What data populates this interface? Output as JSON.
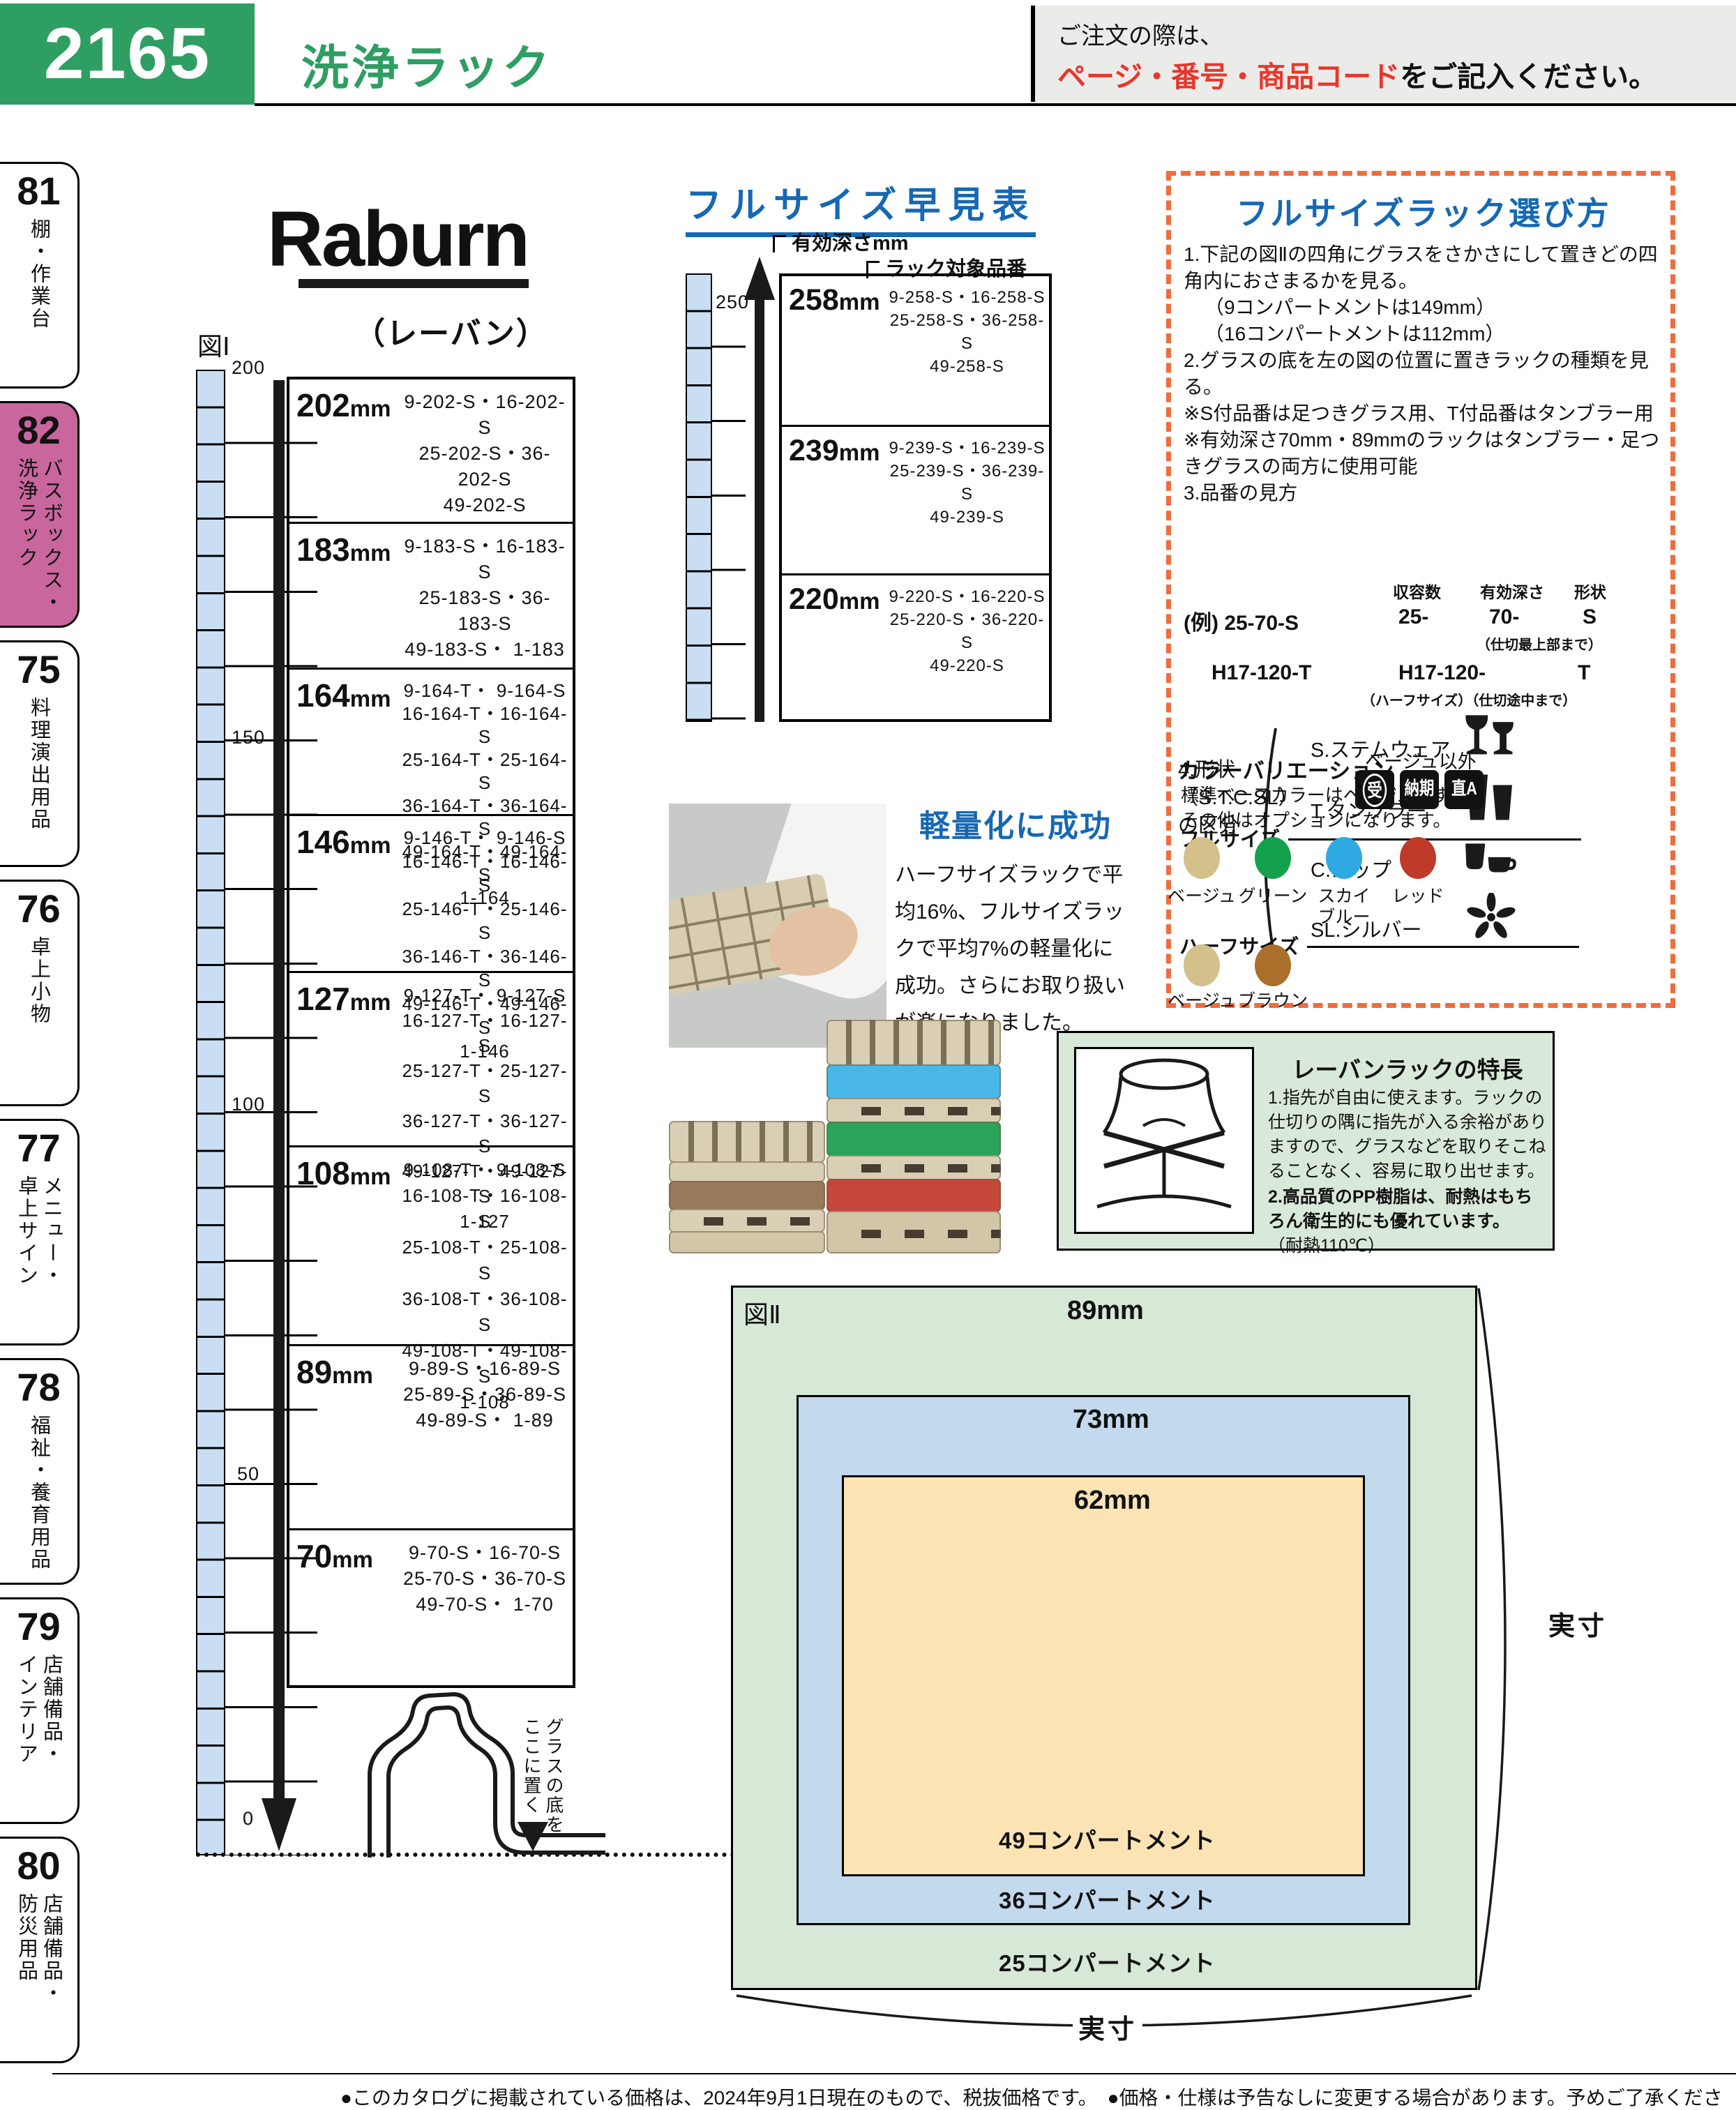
{
  "page": {
    "number": "2165",
    "title": "洗浄ラック",
    "order_line1": "ご注文の際は、",
    "order_red": "ページ・番号・商品コード",
    "order_suffix": "をご記入ください。",
    "footer": "●このカタログに掲載されている価格は、2024年9月1日現在のもので、税抜価格です。　●価格・仕様は予告なしに変更する場合があります。予めご了承ください。",
    "colors": {
      "accent_green": "#2f9e63",
      "heading_blue": "#1668b3",
      "sidebar_active": "#c9669d",
      "dash_orange": "#ed6d3d"
    }
  },
  "sidebar": [
    {
      "num": "81",
      "label": "棚・作業台"
    },
    {
      "num": "82",
      "label": "バスボックス・\n洗浄ラック"
    },
    {
      "num": "75",
      "label": "料理演出用品"
    },
    {
      "num": "76",
      "label": "卓上小物"
    },
    {
      "num": "77",
      "label": "メニュー・\n卓上サイン"
    },
    {
      "num": "78",
      "label": "福祉・養育用品"
    },
    {
      "num": "79",
      "label": "店舗備品・\nインテリア"
    },
    {
      "num": "80",
      "label": "店舗備品・\n防災用品"
    }
  ],
  "brand": {
    "logo": "Raburn",
    "kana": "（レーバン）"
  },
  "fig1": {
    "label": "図Ⅰ",
    "unit": "mm",
    "ticks": [
      "200",
      "150",
      "100",
      "50",
      "0"
    ],
    "glass_note": "グラスの底を\nここに置く",
    "rows": [
      {
        "size": "202",
        "codes": [
          "9-202-S・16-202-S",
          "25-202-S・36-202-S",
          "49-202-S"
        ]
      },
      {
        "size": "183",
        "codes": [
          "9-183-S・16-183-S",
          "25-183-S・36-183-S",
          "49-183-S・ 1-183"
        ]
      },
      {
        "size": "164",
        "codes": [
          "9-164-T・ 9-164-S",
          "16-164-T・16-164-S",
          "25-164-T・25-164-S",
          "36-164-T・36-164-S",
          "49-164-T・49-164-S",
          "1-164"
        ]
      },
      {
        "size": "146",
        "codes": [
          "9-146-T・ 9-146-S",
          "16-146-T・16-146-S",
          "25-146-T・25-146-S",
          "36-146-T・36-146-S",
          "49-146-T・49-146-S",
          "1-146"
        ]
      },
      {
        "size": "127",
        "codes": [
          "9-127-T・ 9-127-S",
          "16-127-T・16-127-S",
          "25-127-T・25-127-S",
          "36-127-T・36-127-S",
          "49-127-T・49-127-S",
          "1-127"
        ]
      },
      {
        "size": "108",
        "codes": [
          "9-108-T・ 9-108-S",
          "16-108-T・16-108-S",
          "25-108-T・25-108-S",
          "36-108-T・36-108-S",
          "49-108-T・49-108-S",
          "1-108"
        ]
      },
      {
        "size": "89",
        "codes": [
          "9-89-S・16-89-S",
          "25-89-S・36-89-S",
          "49-89-S・ 1-89"
        ]
      },
      {
        "size": "70",
        "codes": [
          "9-70-S・16-70-S",
          "25-70-S・36-70-S",
          "49-70-S・ 1-70"
        ]
      }
    ]
  },
  "quick": {
    "title": "フルサイズ早見表",
    "depth_label": "有効深さmm",
    "rack_label": "ラック対象品番",
    "tick": "250",
    "unit": "mm",
    "rows": [
      {
        "size": "258",
        "codes": [
          "9-258-S・16-258-S",
          "25-258-S・36-258-S",
          "49-258-S"
        ]
      },
      {
        "size": "239",
        "codes": [
          "9-239-S・16-239-S",
          "25-239-S・36-239-S",
          "49-239-S"
        ]
      },
      {
        "size": "220",
        "codes": [
          "9-220-S・16-220-S",
          "25-220-S・36-220-S",
          "49-220-S"
        ]
      }
    ]
  },
  "lightweight": {
    "title": "軽量化に成功",
    "body": "ハーフサイズラックで平均16%、フルサイズラックで平均7%の軽量化に成功。さらにお取り扱いが楽になりました。"
  },
  "howto": {
    "title": "フルサイズラック選び方",
    "step1": "1.下記の図Ⅱの四角にグラスをさかさにして置きどの四角内におさまるかを見る。",
    "step1a": "（9コンパートメントは149mm）",
    "step1b": "（16コンパートメントは112mm）",
    "step2": "2.グラスの底を左の図の位置に置きラックの種類を見る。",
    "note1": "※S付品番は足つきグラス用、T付品番はタンブラー用",
    "note2": "※有効深さ70mm・89mmのラックはタンブラー・足つきグラスの両方に使用可能",
    "step3": "3.品番の見方",
    "spec_headers": [
      "収容数",
      "有効深さ",
      "形状"
    ],
    "ex1_label": "(例) 25-70-S",
    "ex1_parts": [
      "25-",
      "70-",
      "S"
    ],
    "ex1_note": "（仕切最上部まで）",
    "ex2_label": "H17-120-T",
    "ex2_parts": [
      "H17-120-",
      "T"
    ],
    "ex2_note": "（ハーフサイズ）（仕切途中まで）",
    "step4": "4.形状\n（S.T.C.SL）\nの区分",
    "shapes": [
      {
        "label": "S.ステムウェア"
      },
      {
        "label": "T.タンブラー"
      },
      {
        "label": "C.カップ"
      },
      {
        "label": "SL.シルバー"
      }
    ],
    "colors": {
      "title": "カラーバリエーション",
      "line1": "標準ベースカラーはベージュです。",
      "line2": "その他はオプションになります。",
      "other_label": "ベージュ以外",
      "badges": [
        "受",
        "納期",
        "直A"
      ],
      "full_label": "フルサイズ",
      "full": [
        {
          "name": "ベージュ",
          "hex": "#d3c08b"
        },
        {
          "name": "グリーン",
          "hex": "#13a24b"
        },
        {
          "name": "スカイ\nブルー",
          "hex": "#2fa9e1"
        },
        {
          "name": "レッド",
          "hex": "#c03a2a"
        }
      ],
      "half_label": "ハーフサイズ",
      "half": [
        {
          "name": "ベージュ",
          "hex": "#d3c08b"
        },
        {
          "name": "ブラウン",
          "hex": "#aa702b"
        }
      ]
    }
  },
  "features": {
    "title": "レーバンラックの特長",
    "item1": "1.指先が自由に使えます。ラックの仕切りの隅に指先が入る余裕がありますので、グラスなどを取りそこねることなく、容易に取り出せます。",
    "item2": "2.高品質のPP樹脂は、耐熱はもちろん衛生的にも優れています。",
    "item2_note": "（耐熱110℃）"
  },
  "fig2": {
    "label": "図Ⅱ",
    "outer_size": "89mm",
    "middle_size": "73mm",
    "inner_size": "62mm",
    "inner_comp": "49コンパートメント",
    "middle_comp": "36コンパートメント",
    "outer_comp": "25コンパートメント",
    "actual": "実寸"
  }
}
